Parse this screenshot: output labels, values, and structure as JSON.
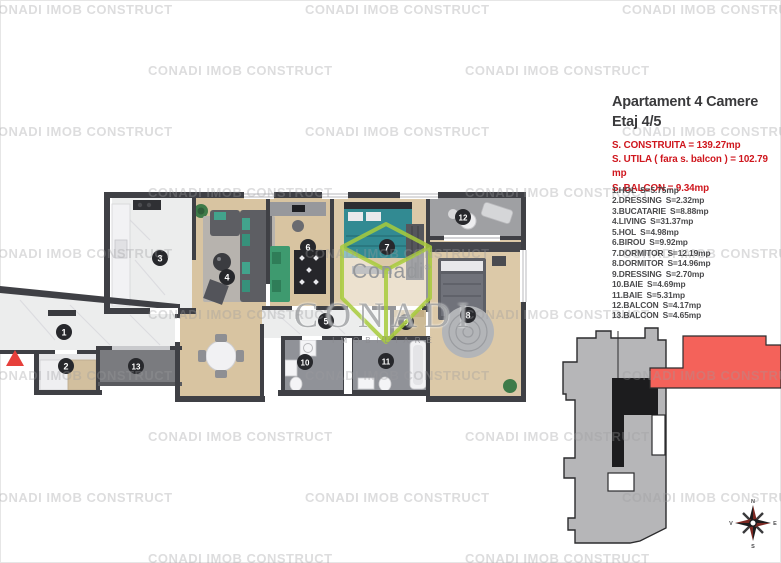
{
  "watermark": {
    "text": "CONADI IMOB CONSTRUCT"
  },
  "header": {
    "title_line1": "Apartament 4 Camere",
    "title_line2": "Etaj 4/5"
  },
  "summary": {
    "line1": "S. CONSTRUITA = 139.27mp",
    "line2": "S. UTILA ( fara s. balcon ) = 102.79 mp",
    "line3": "S. BALCON = 9.34mp",
    "text_color": "#cf161d"
  },
  "rooms": [
    {
      "num": "1",
      "label": "1.HOL",
      "area": "S=5.75mp"
    },
    {
      "num": "2",
      "label": "2.DRESSING",
      "area": "S=2.32mp"
    },
    {
      "num": "3",
      "label": "3.BUCATARIE",
      "area": "S=8.88mp"
    },
    {
      "num": "4",
      "label": "4.LIVING",
      "area": "S=31.37mp"
    },
    {
      "num": "5",
      "label": "5.HOL",
      "area": "S=4.98mp"
    },
    {
      "num": "6",
      "label": "6.BIROU",
      "area": "S=9.92mp"
    },
    {
      "num": "7",
      "label": "7.DORMITOR",
      "area": "S=12.19mp"
    },
    {
      "num": "8",
      "label": "8.DORMITOR",
      "area": "S=14.96mp"
    },
    {
      "num": "9",
      "label": "9.DRESSING",
      "area": "S=2.70mp"
    },
    {
      "num": "10",
      "label": "10.BAIE",
      "area": "S=4.69mp"
    },
    {
      "num": "11",
      "label": "11.BAIE",
      "area": "S=5.31mp"
    },
    {
      "num": "12",
      "label": "12.BALCON",
      "area": "S=4.17mp"
    },
    {
      "num": "13",
      "label": "13.BALCON",
      "area": "S=4.65mp"
    }
  ],
  "logo": {
    "wordmark": "Conadi",
    "registered": "®",
    "big_text": "CONADI",
    "sub_text": "IMOBILIARE",
    "green": "#a8cc3c"
  },
  "site_plan": {
    "building_color": "#b6b6b8",
    "core_color": "#1c1c1e",
    "highlight_color": "#f4625a"
  },
  "compass": {
    "north": "N",
    "east": "E",
    "south": "S",
    "west": "V"
  }
}
